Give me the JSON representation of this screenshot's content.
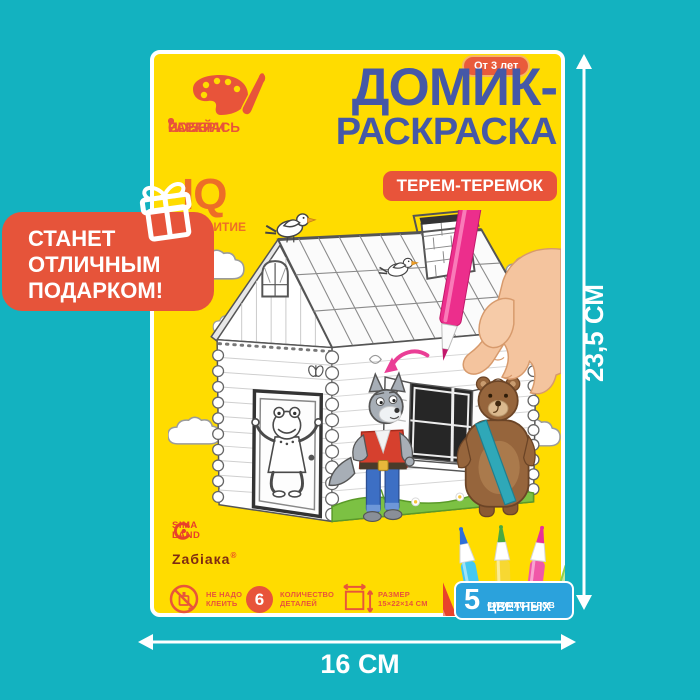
{
  "colors": {
    "background": "#13B2C0",
    "card": "#FFDC00",
    "accent_red": "#E8543A",
    "title_blue": "#4558A7",
    "iq_orange": "#ED6E27",
    "badge_blue": "#2BA2DC",
    "held_marker_pink": "#EC2E8C"
  },
  "promo_bubble": {
    "line1": "СТАНЕТ",
    "line2": "ОТЛИЧНЫМ",
    "line3": "ПОДАРКОМ!"
  },
  "card": {
    "age_badge": "От 3 лет",
    "title_line1": "ДОМИК-",
    "title_line2": "РАСКРАСКА",
    "product_badge": "ТЕРЕМ-ТЕРЕМОК",
    "benefits": [
      "СОБЕРИ",
      "РАСКРАСЬ",
      "ИГРАЙ"
    ],
    "iq_label": "IQ",
    "iq_word": "РАЗВИТИЕ",
    "brand_sima_line1": "SIMA",
    "brand_sima_line2": "LAND",
    "brand_zabiaka": "Zабiака",
    "brand_reg": "®",
    "features": [
      {
        "line1": "НЕ НАДО",
        "line2": "КЛЕИТЬ"
      },
      {
        "value": "6",
        "line1": "КОЛИЧЕСТВО",
        "line2": "ДЕТАЛЕЙ"
      },
      {
        "line1": "РАЗМЕР",
        "line2": "15×22×14 СМ"
      }
    ],
    "markers_badge": {
      "count": "5",
      "line1": "ЦВЕТНЫХ",
      "line2": "ФЛОМАСТЕРОВ"
    }
  },
  "dimensions": {
    "height_label": "23,5 СМ",
    "width_label": "16 СМ"
  },
  "icons": {
    "promo": "gift-icon",
    "benefits": "palette-icon",
    "feature1": "no-glue-icon",
    "feature2": "count-circle",
    "feature3": "size-icon"
  },
  "marker_fan_body_colors": [
    "#E8432B",
    "#45C8F0",
    "#F7D832",
    "#F058A8",
    "#8FD14F"
  ],
  "marker_fan_tip_colors": [
    "#D93327",
    "#2E6FD8",
    "#49A942",
    "#E8309A",
    "#54B43C"
  ]
}
